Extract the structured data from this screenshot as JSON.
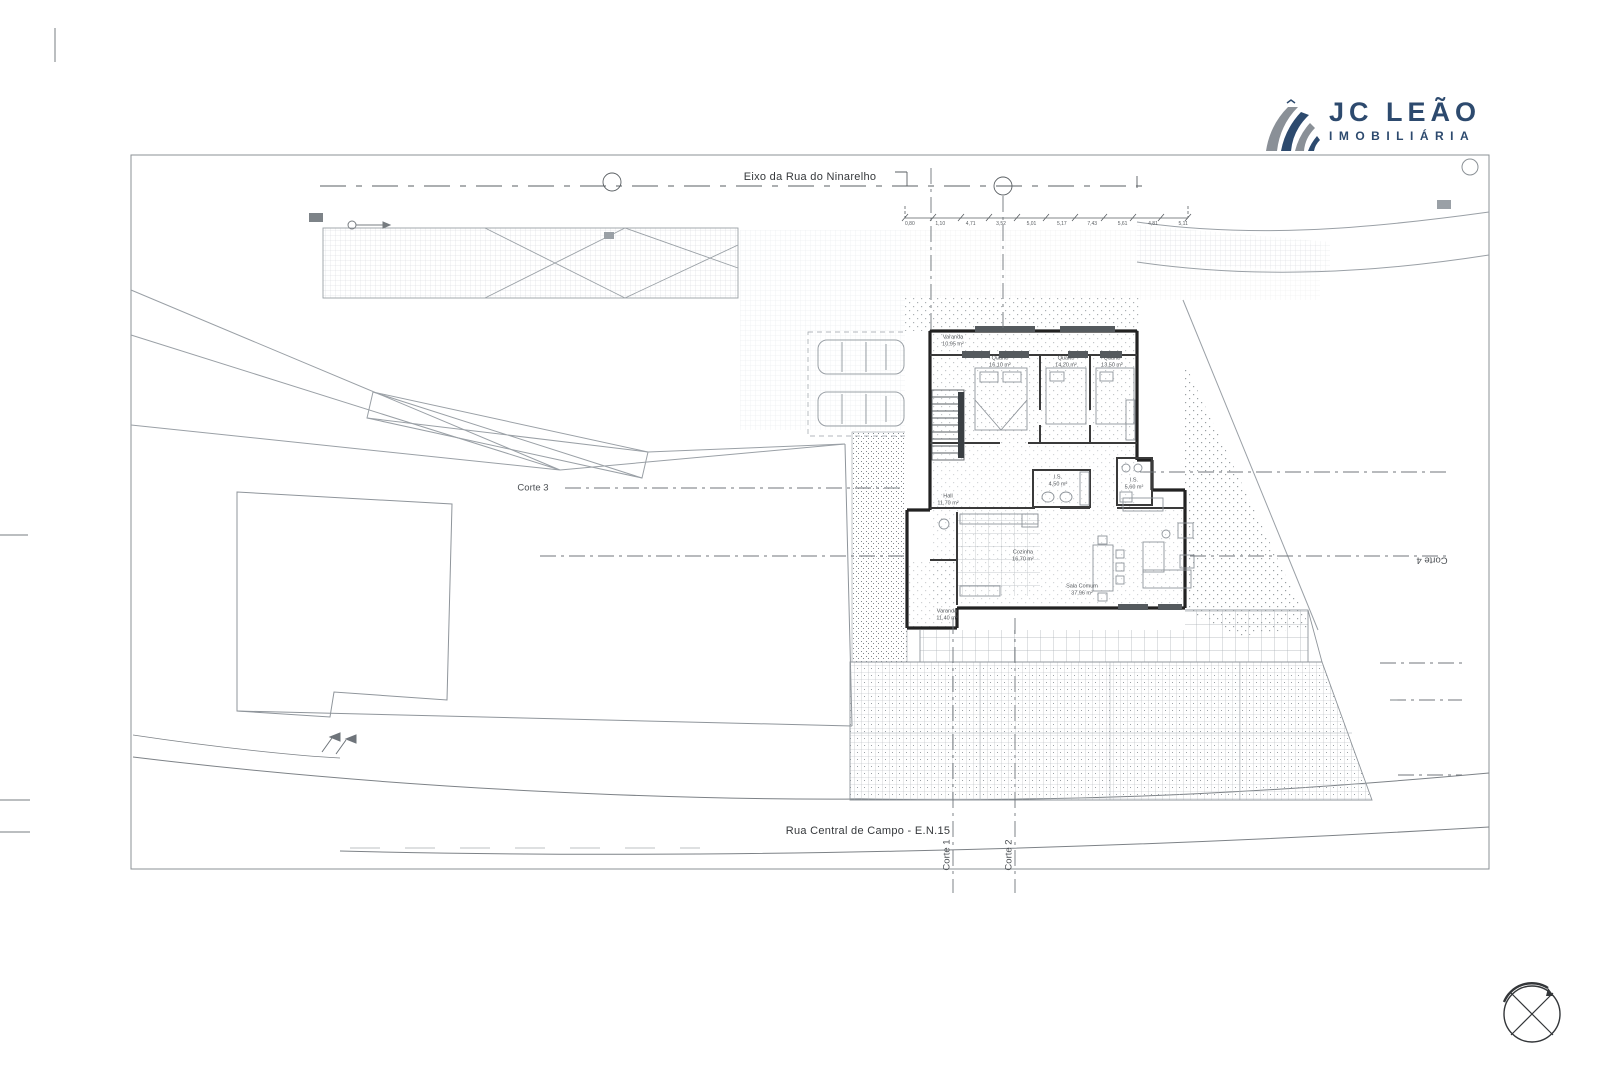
{
  "logo": {
    "title": "JC LEÃO",
    "subtitle": "IMOBILIÁRIA",
    "icon": "diagonal-swoosh-stripes",
    "color_navy": "#2d4a6e",
    "color_gray": "#8a9097"
  },
  "labels": {
    "top_axis": "Eixo da Rua do Ninarelho",
    "bottom_road": "Rua Central de Campo - E.N.15",
    "corte_1": "Corte 1",
    "corte_2": "Corte 2",
    "corte_3": "Corte 3",
    "corte_4": "Corte 4"
  },
  "rooms": [
    {
      "name": "Varanda",
      "area": "10,95 m²"
    },
    {
      "name": "Quarto",
      "area": "16,10 m²"
    },
    {
      "name": "Quarto",
      "area": "14,20 m²"
    },
    {
      "name": "Quarto",
      "area": "13,50 m²"
    },
    {
      "name": "I.S.",
      "area": "4,50 m²"
    },
    {
      "name": "I.S.",
      "area": "5,60 m²"
    },
    {
      "name": "Hall",
      "area": "11,70 m²"
    },
    {
      "name": "Cozinha",
      "area": "16,70 m²"
    },
    {
      "name": "Sala Comum",
      "area": "37,96 m²"
    },
    {
      "name": "Varanda",
      "area": "11,40 m²"
    }
  ],
  "dimensions": {
    "top_chain": [
      "0,80",
      "1,10",
      "4,71",
      "3,52",
      "5,01",
      "5,17",
      "7,43",
      "5,61",
      "4,81",
      "5,11"
    ]
  },
  "colors": {
    "wall": "#222222",
    "line_light": "#9aa0a6",
    "line_mid": "#6e747a",
    "text": "#3f4347"
  }
}
